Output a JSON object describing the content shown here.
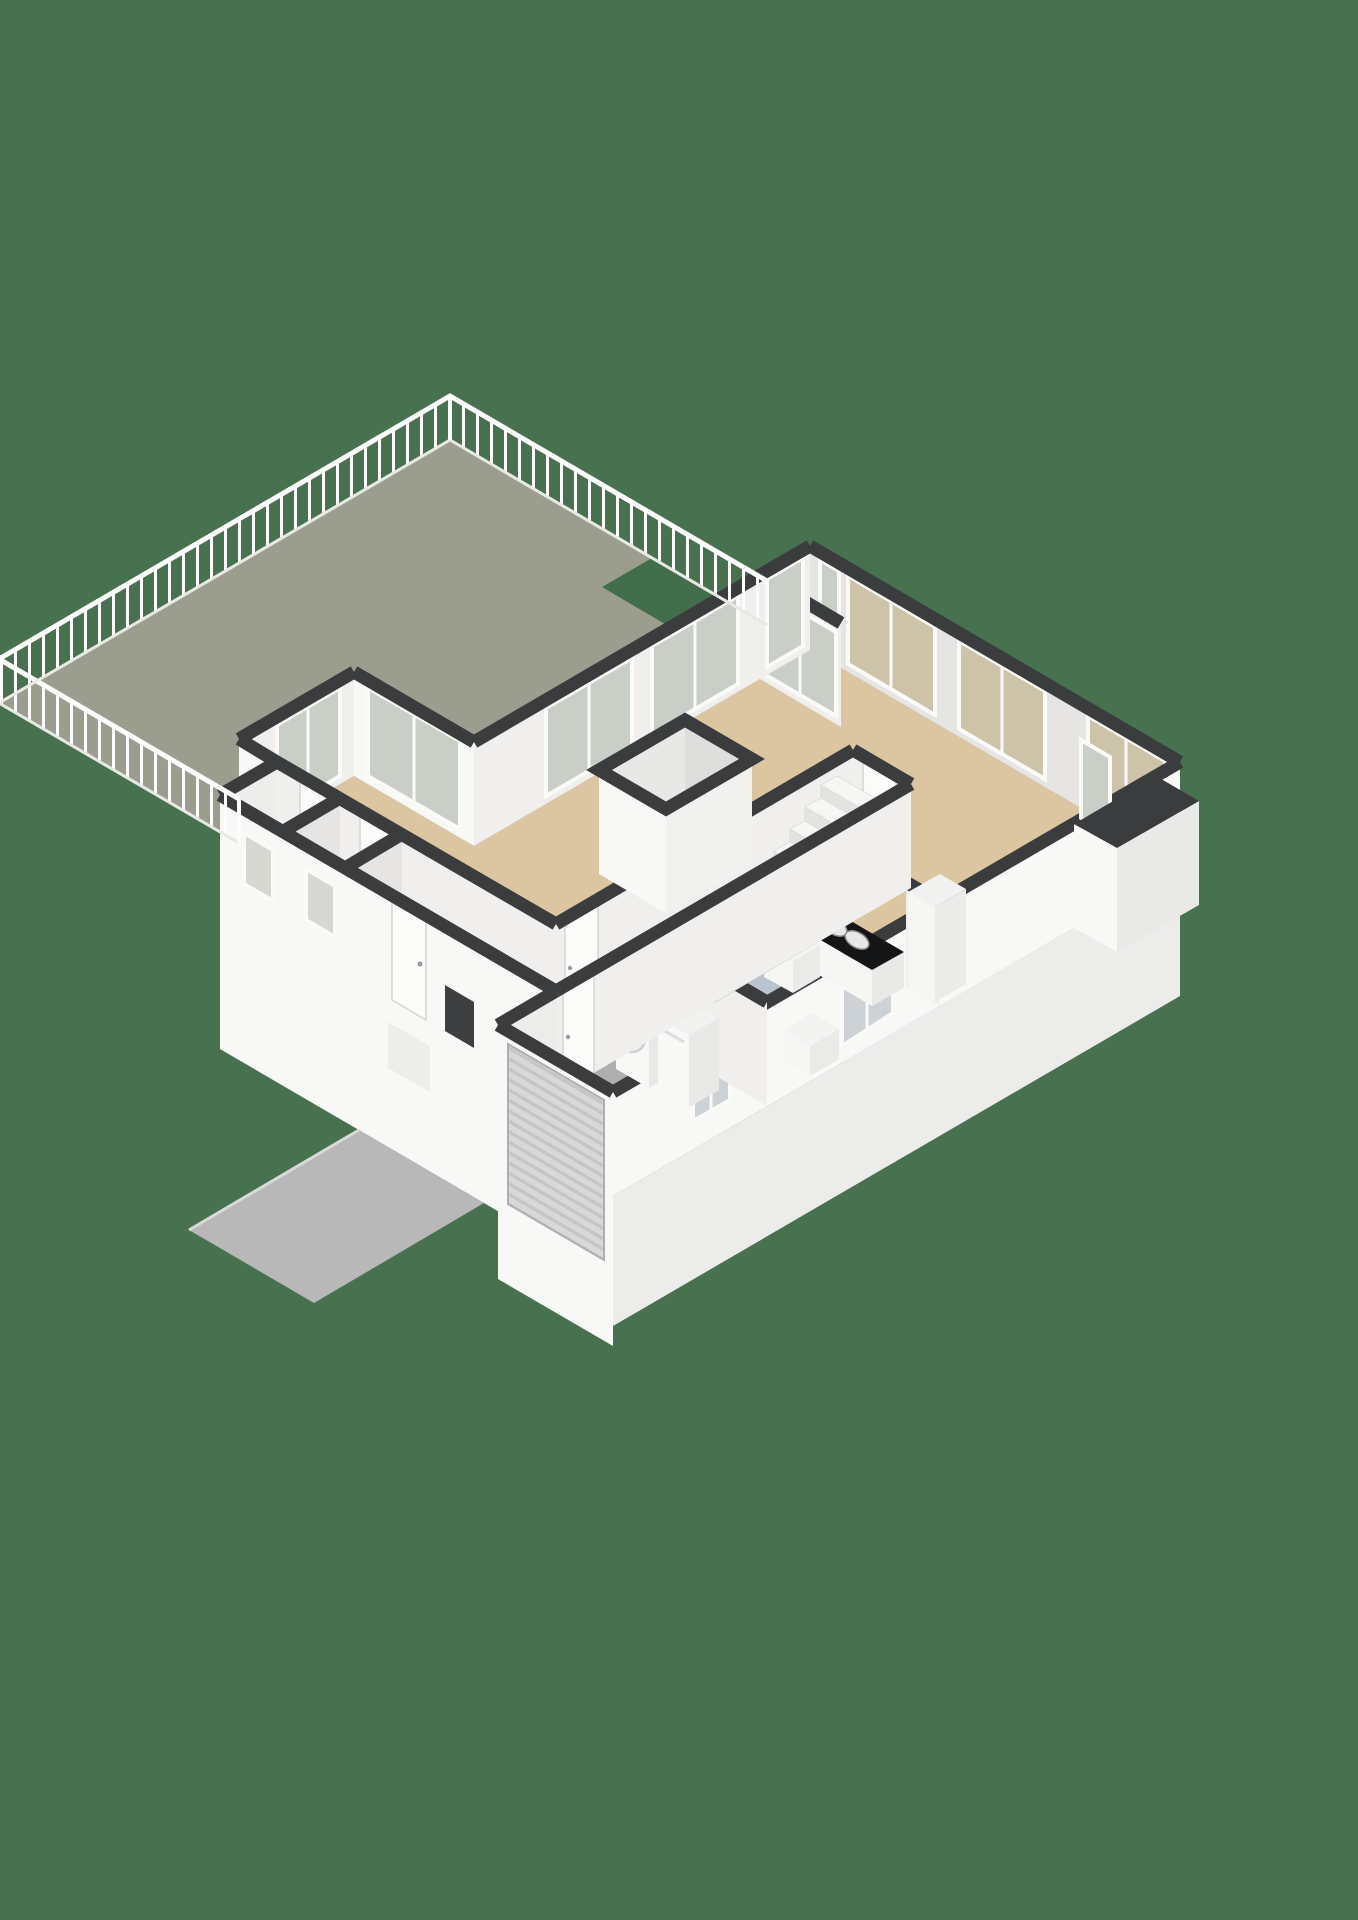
{
  "canvas": {
    "width": 1358,
    "height": 1920
  },
  "scene_type": "3d-isometric-floor-plan",
  "palette": {
    "background": "#47714F",
    "terrace_floor": "#9B9E8F",
    "notch_green": "#436E4C",
    "floor_tan": "#DCC6A2",
    "floor_hall": "#CDA76F",
    "floor_blue": "#B9C4CF",
    "floor_garage": "#AFAFB0",
    "wall_face": "#F0EFED",
    "wall_face_shaded": "#E6E5E3",
    "wall_face_bright": "#F8F8F6",
    "wall_inner": "#DEDEDC",
    "wall_top": "#3A3C3E",
    "glass_clear": "#C9CEC6",
    "glass_curtain": "#CDC3A8",
    "glass_frost": "#D8D8D2",
    "glass_blue": "#CCD2D6",
    "frame_white": "#FAFAF8",
    "counter_top": "#141516",
    "cabinet_white": "#F6F6F5",
    "railing_white": "#FDFDFD",
    "steps_white": "#F4F4F2",
    "green_strip": "#4E7B57",
    "driveway": "#B8B8B9",
    "appliance_white": "#F8F8F7",
    "stair_tread": "#F6F6F5",
    "stair_riser": "#E3E3E2",
    "door_leaf": "#FBFBFA",
    "roller_door": "#D8D8D8",
    "roller_slat": "#C6C6C6"
  },
  "rooms": [
    {
      "name": "roof-terrace",
      "floor": "terrace_floor",
      "features": [
        "white-railing",
        "green-cutout",
        "access-steps"
      ]
    },
    {
      "name": "living-room",
      "floor": "floor_tan",
      "features": [
        "sliding-doors-to-terrace",
        "open-stair-void-block"
      ]
    },
    {
      "name": "dining-area",
      "floor": "floor_tan",
      "features": [
        "curtained-window-wall",
        "bay-window"
      ]
    },
    {
      "name": "kitchen",
      "floor": "floor_blue",
      "features": [
        "counter-with-sink",
        "tall-cabinet",
        "window"
      ]
    },
    {
      "name": "hallway",
      "floor": "floor_hall",
      "features": [
        "staircase",
        "interior-doors"
      ]
    },
    {
      "name": "toilet",
      "floor": "floor_hall",
      "features": [
        "frosted-window"
      ]
    },
    {
      "name": "storage-room",
      "floor": "floor_hall",
      "features": []
    },
    {
      "name": "garage",
      "floor": "floor_garage",
      "features": [
        "roller-door",
        "washing-machine",
        "dryer",
        "small-window"
      ]
    }
  ],
  "furniture": [
    {
      "name": "kitchen-counter",
      "top": "counter_top",
      "basins": 2,
      "faucet": true
    },
    {
      "name": "washing-machine",
      "type": "front-loader"
    },
    {
      "name": "dryer",
      "type": "appliance"
    },
    {
      "name": "staircase",
      "visible_treads": 7
    },
    {
      "name": "terrace-steps",
      "treads": 5
    }
  ],
  "openings": {
    "front_door": 1,
    "interior_doors": 5,
    "sliding_glass_walls": 6,
    "curtained_windows": 3,
    "small_windows": 6,
    "garage_roller_door": 1
  }
}
